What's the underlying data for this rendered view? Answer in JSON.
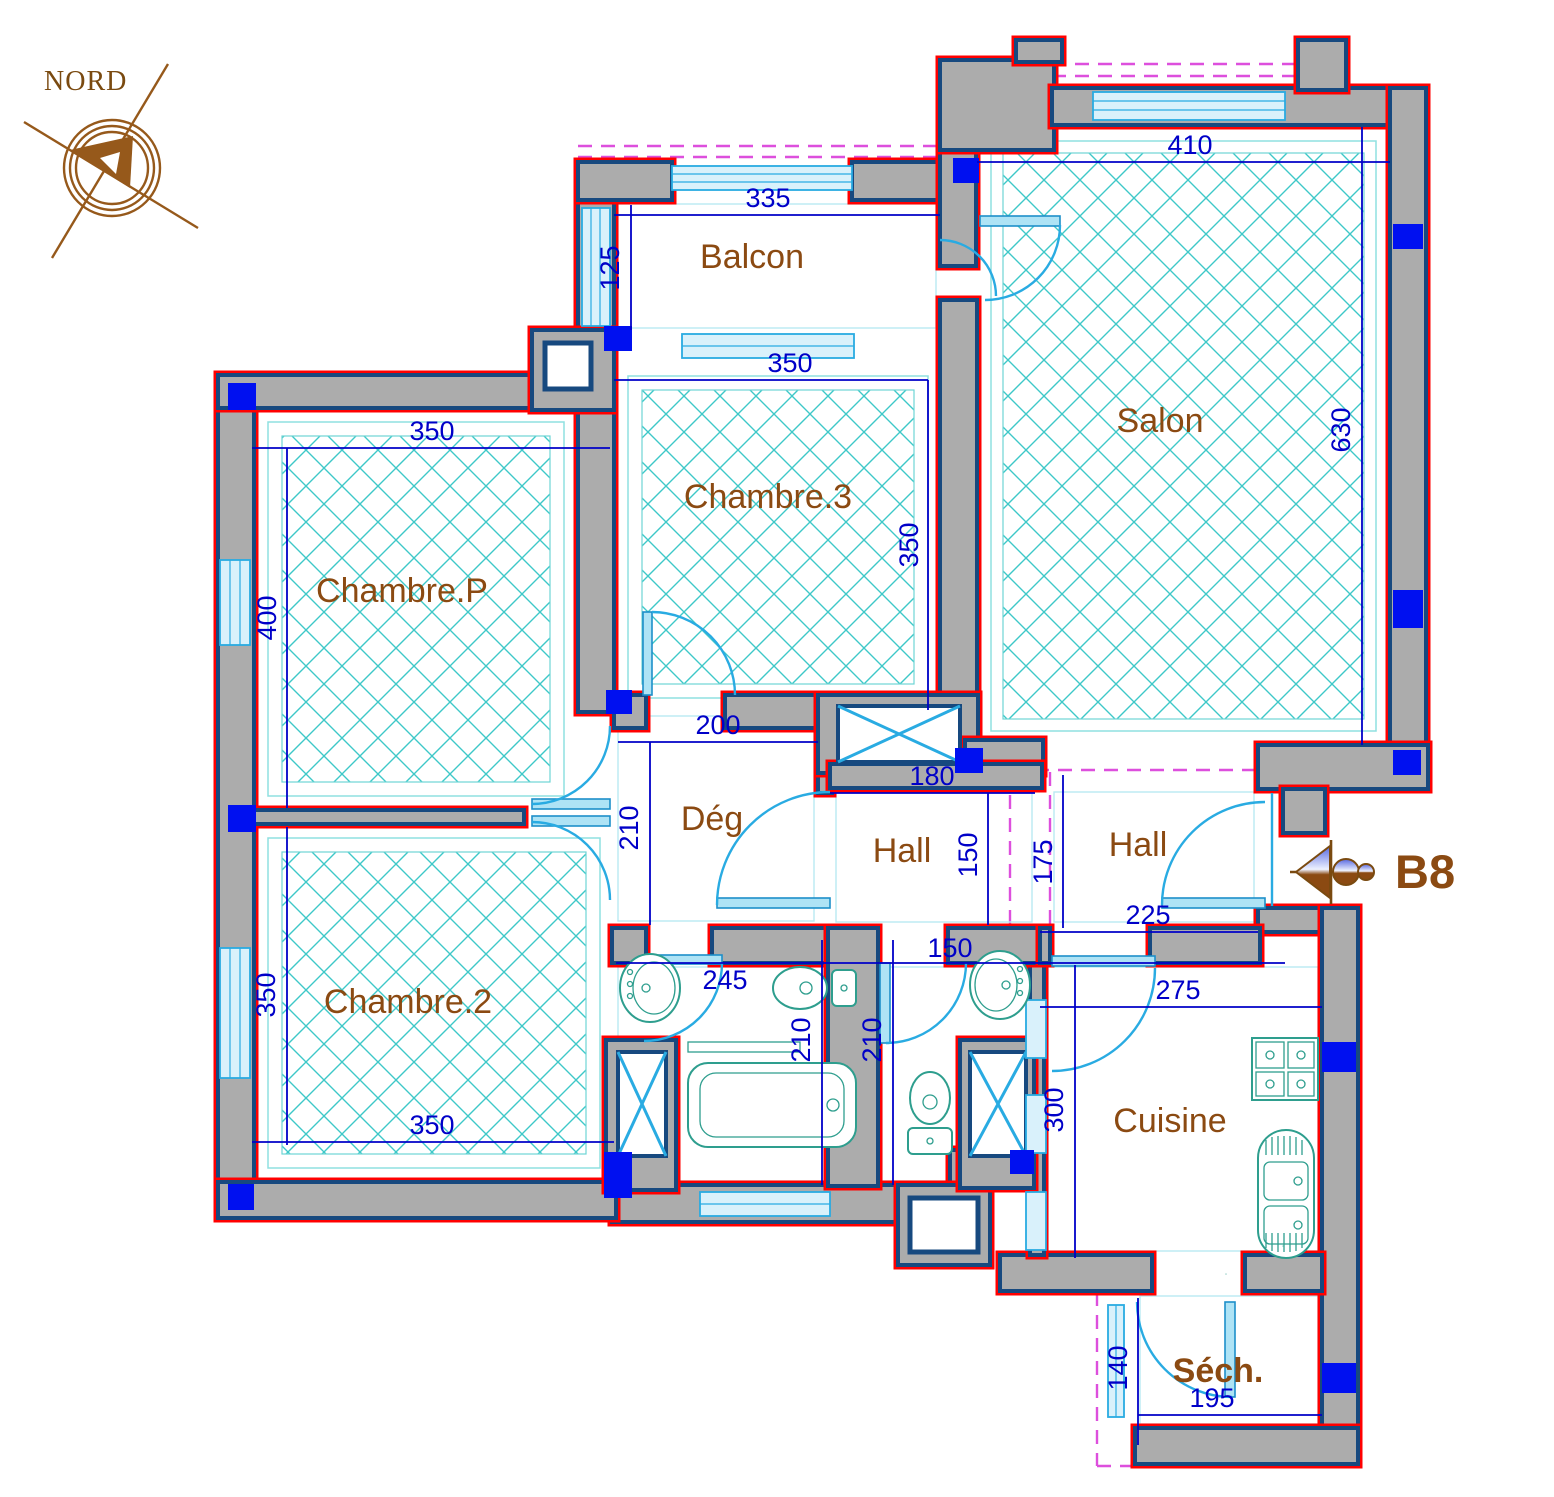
{
  "drawing": {
    "type": "apartment floor plan",
    "unit_label": "B8",
    "north_label": "NORD"
  },
  "rooms": {
    "balcon": "Balcon",
    "salon": "Salon",
    "chambre3": "Chambre.3",
    "chambreP": "Chambre.P",
    "chambre2": "Chambre.2",
    "deg": "Dég",
    "hall1": "Hall",
    "hall2": "Hall",
    "cuisine": "Cuisine",
    "sech": "Séch."
  },
  "dims": {
    "balcon_w": "335",
    "balcon_d": "125",
    "salon_w": "410",
    "salon_h": "630",
    "ch3_w": "350",
    "ch3_h": "350",
    "chp_w": "350",
    "chp_h": "400",
    "ch2_h": "350",
    "ch2_w": "350",
    "deg_w": "200",
    "deg_h": "210",
    "hall1_w": "180",
    "hall1_h": "150",
    "hall2_h": "175",
    "hall2_w": "225",
    "sdb_w": "245",
    "sdb_h": "210",
    "wc_w": "150",
    "wc_h": "210",
    "cuisine_w": "275",
    "cuisine_h": "300",
    "sech_h": "140",
    "sech_w": "195"
  },
  "colors": {
    "wall_fill": "#ACACAC",
    "wall_outline_outer": "#FF0000",
    "wall_outline_inner": "#17497F",
    "column": "#0010F0",
    "dimension": "#0000C8",
    "hatch": "#3EC8C8",
    "door_window": "#29ABE2",
    "fixtures": "#2E9E8E",
    "overhang_dashed": "#DD4FDD",
    "labels": "#8B4A12"
  }
}
